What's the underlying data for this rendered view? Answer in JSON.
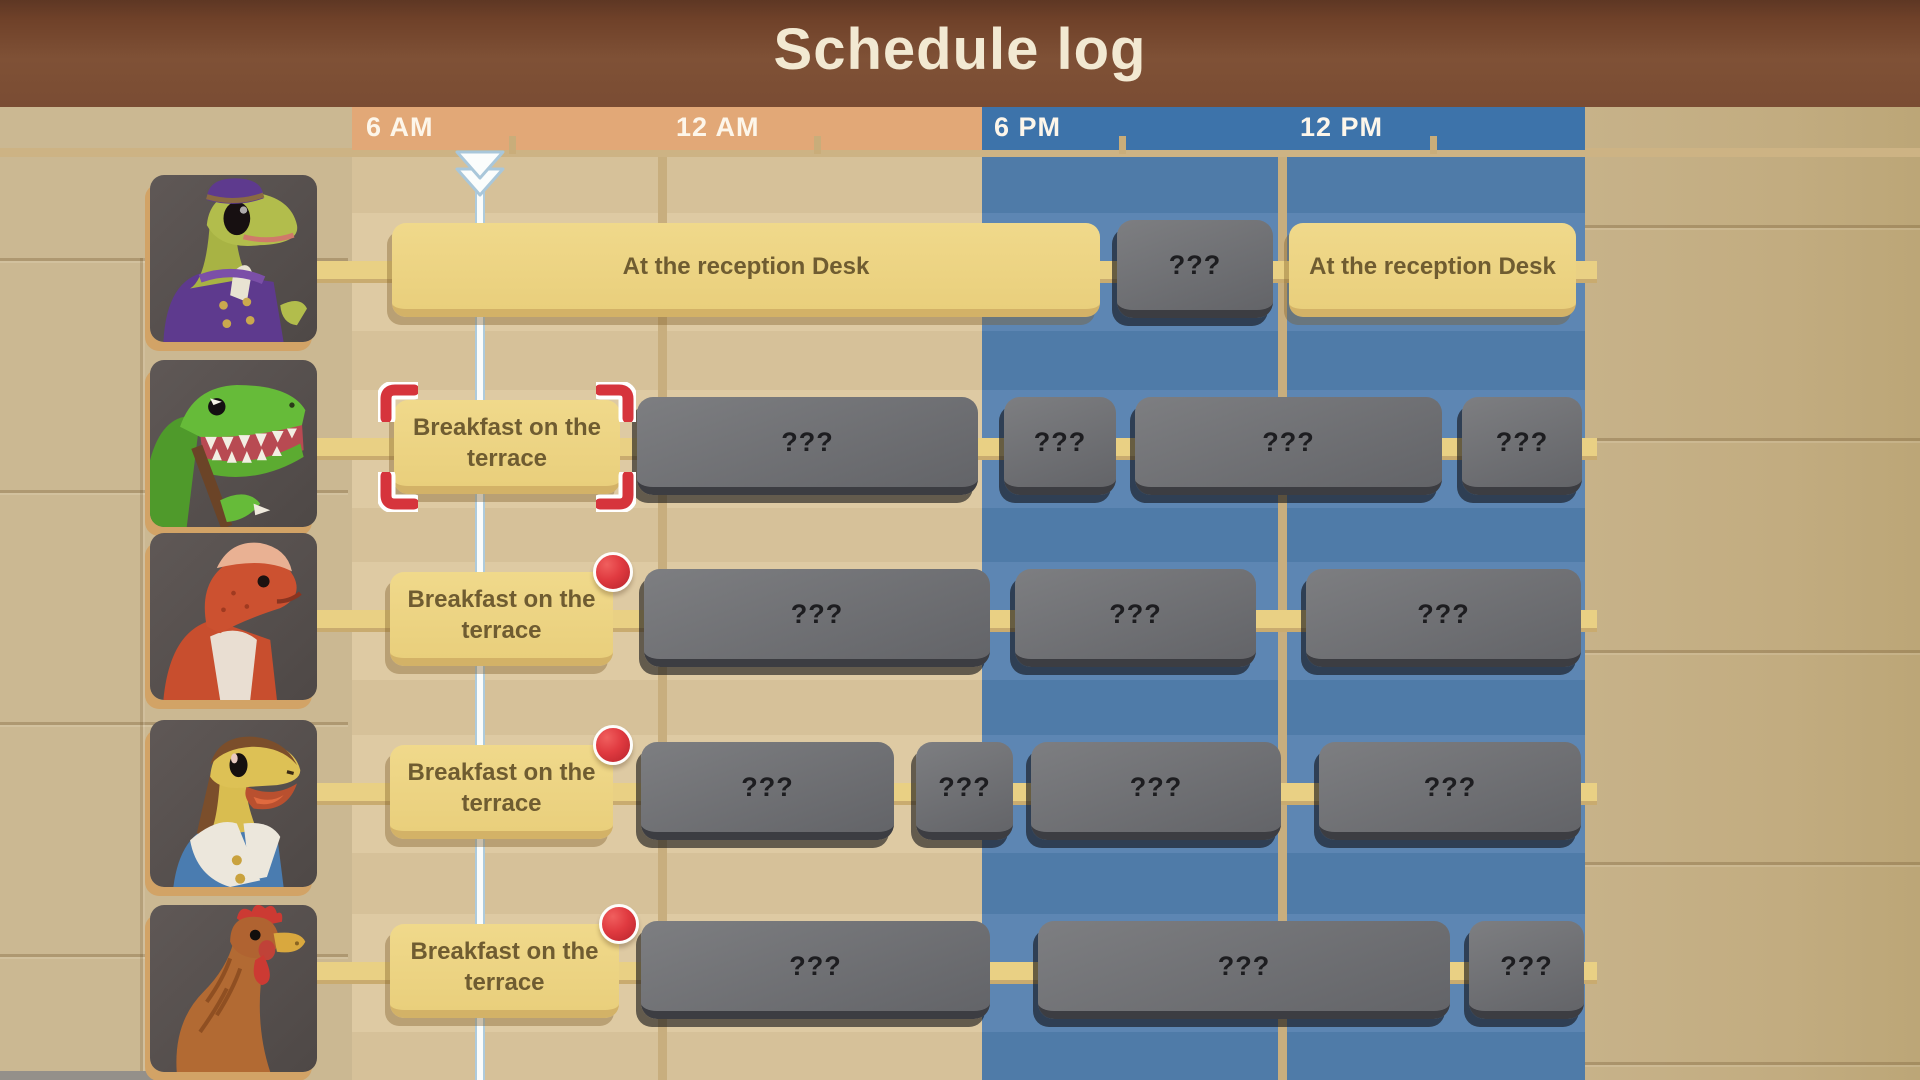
{
  "title": "Schedule log",
  "colors": {
    "title_bar": "#7a4c33",
    "am_header": "#e2a877",
    "pm_header": "#3d73aa",
    "am_body": "#d6c199",
    "pm_body": "#4f7ba8",
    "activity_block": "#eed685",
    "unknown_block": "#707175",
    "alert_dot": "#e23a3f",
    "selection_corners": "#d6343c",
    "time_marker": "#ffffff"
  },
  "timeline": {
    "labels": [
      {
        "text": "6 AM",
        "x": 366,
        "period": "am"
      },
      {
        "text": "12 AM",
        "x": 676,
        "period": "am"
      },
      {
        "text": "6 PM",
        "x": 994,
        "period": "pm"
      },
      {
        "text": "12 PM",
        "x": 1300,
        "period": "pm"
      }
    ],
    "ticks_x": [
      509,
      814,
      1119,
      1430
    ],
    "day_gridlines_x": [
      658,
      1278
    ],
    "current_time_marker_x": 480
  },
  "rows": [
    {
      "character": "bellhop-dinosaur-portrait",
      "portrait_symbol": "portrait-bellhop",
      "portrait_y": 175,
      "top": 223,
      "blocks": [
        {
          "kind": "activity",
          "label": "At the reception Desk",
          "left": 392,
          "width": 708
        },
        {
          "kind": "unknown",
          "label": "???",
          "left": 1117,
          "width": 156
        },
        {
          "kind": "activity",
          "label": "At the reception Desk",
          "left": 1289,
          "width": 287
        }
      ]
    },
    {
      "character": "green-raptor-portrait",
      "portrait_symbol": "portrait-raptor",
      "portrait_y": 360,
      "top": 400,
      "blocks": [
        {
          "kind": "activity",
          "label": "Breakfast on the terrace",
          "left": 394,
          "width": 226,
          "selected": true
        },
        {
          "kind": "unknown",
          "label": "???",
          "left": 637,
          "width": 341
        },
        {
          "kind": "unknown",
          "label": "???",
          "left": 1004,
          "width": 112
        },
        {
          "kind": "unknown",
          "label": "???",
          "left": 1135,
          "width": 307
        },
        {
          "kind": "unknown",
          "label": "???",
          "left": 1462,
          "width": 120
        }
      ]
    },
    {
      "character": "red-pachy-dinosaur-portrait",
      "portrait_symbol": "portrait-pachy",
      "portrait_y": 533,
      "top": 572,
      "blocks": [
        {
          "kind": "activity",
          "label": "Breakfast on the terrace",
          "left": 390,
          "width": 223,
          "alert": true
        },
        {
          "kind": "unknown",
          "label": "???",
          "left": 644,
          "width": 346
        },
        {
          "kind": "unknown",
          "label": "???",
          "left": 1015,
          "width": 241
        },
        {
          "kind": "unknown",
          "label": "???",
          "left": 1306,
          "width": 275
        }
      ]
    },
    {
      "character": "yellow-dinosaur-in-vest-portrait",
      "portrait_symbol": "portrait-vest",
      "portrait_y": 720,
      "top": 745,
      "blocks": [
        {
          "kind": "activity",
          "label": "Breakfast on the terrace",
          "left": 390,
          "width": 223,
          "alert": true
        },
        {
          "kind": "unknown",
          "label": "???",
          "left": 641,
          "width": 253
        },
        {
          "kind": "unknown",
          "label": "???",
          "left": 916,
          "width": 97
        },
        {
          "kind": "unknown",
          "label": "???",
          "left": 1031,
          "width": 250
        },
        {
          "kind": "unknown",
          "label": "???",
          "left": 1319,
          "width": 262
        }
      ]
    },
    {
      "character": "rooster-portrait",
      "portrait_symbol": "portrait-rooster",
      "portrait_y": 905,
      "top": 924,
      "blocks": [
        {
          "kind": "activity",
          "label": "Breakfast on the terrace",
          "left": 390,
          "width": 229,
          "alert": true
        },
        {
          "kind": "unknown",
          "label": "???",
          "left": 641,
          "width": 349
        },
        {
          "kind": "unknown",
          "label": "???",
          "left": 1038,
          "width": 412
        },
        {
          "kind": "unknown",
          "label": "???",
          "left": 1469,
          "width": 115
        }
      ]
    }
  ]
}
